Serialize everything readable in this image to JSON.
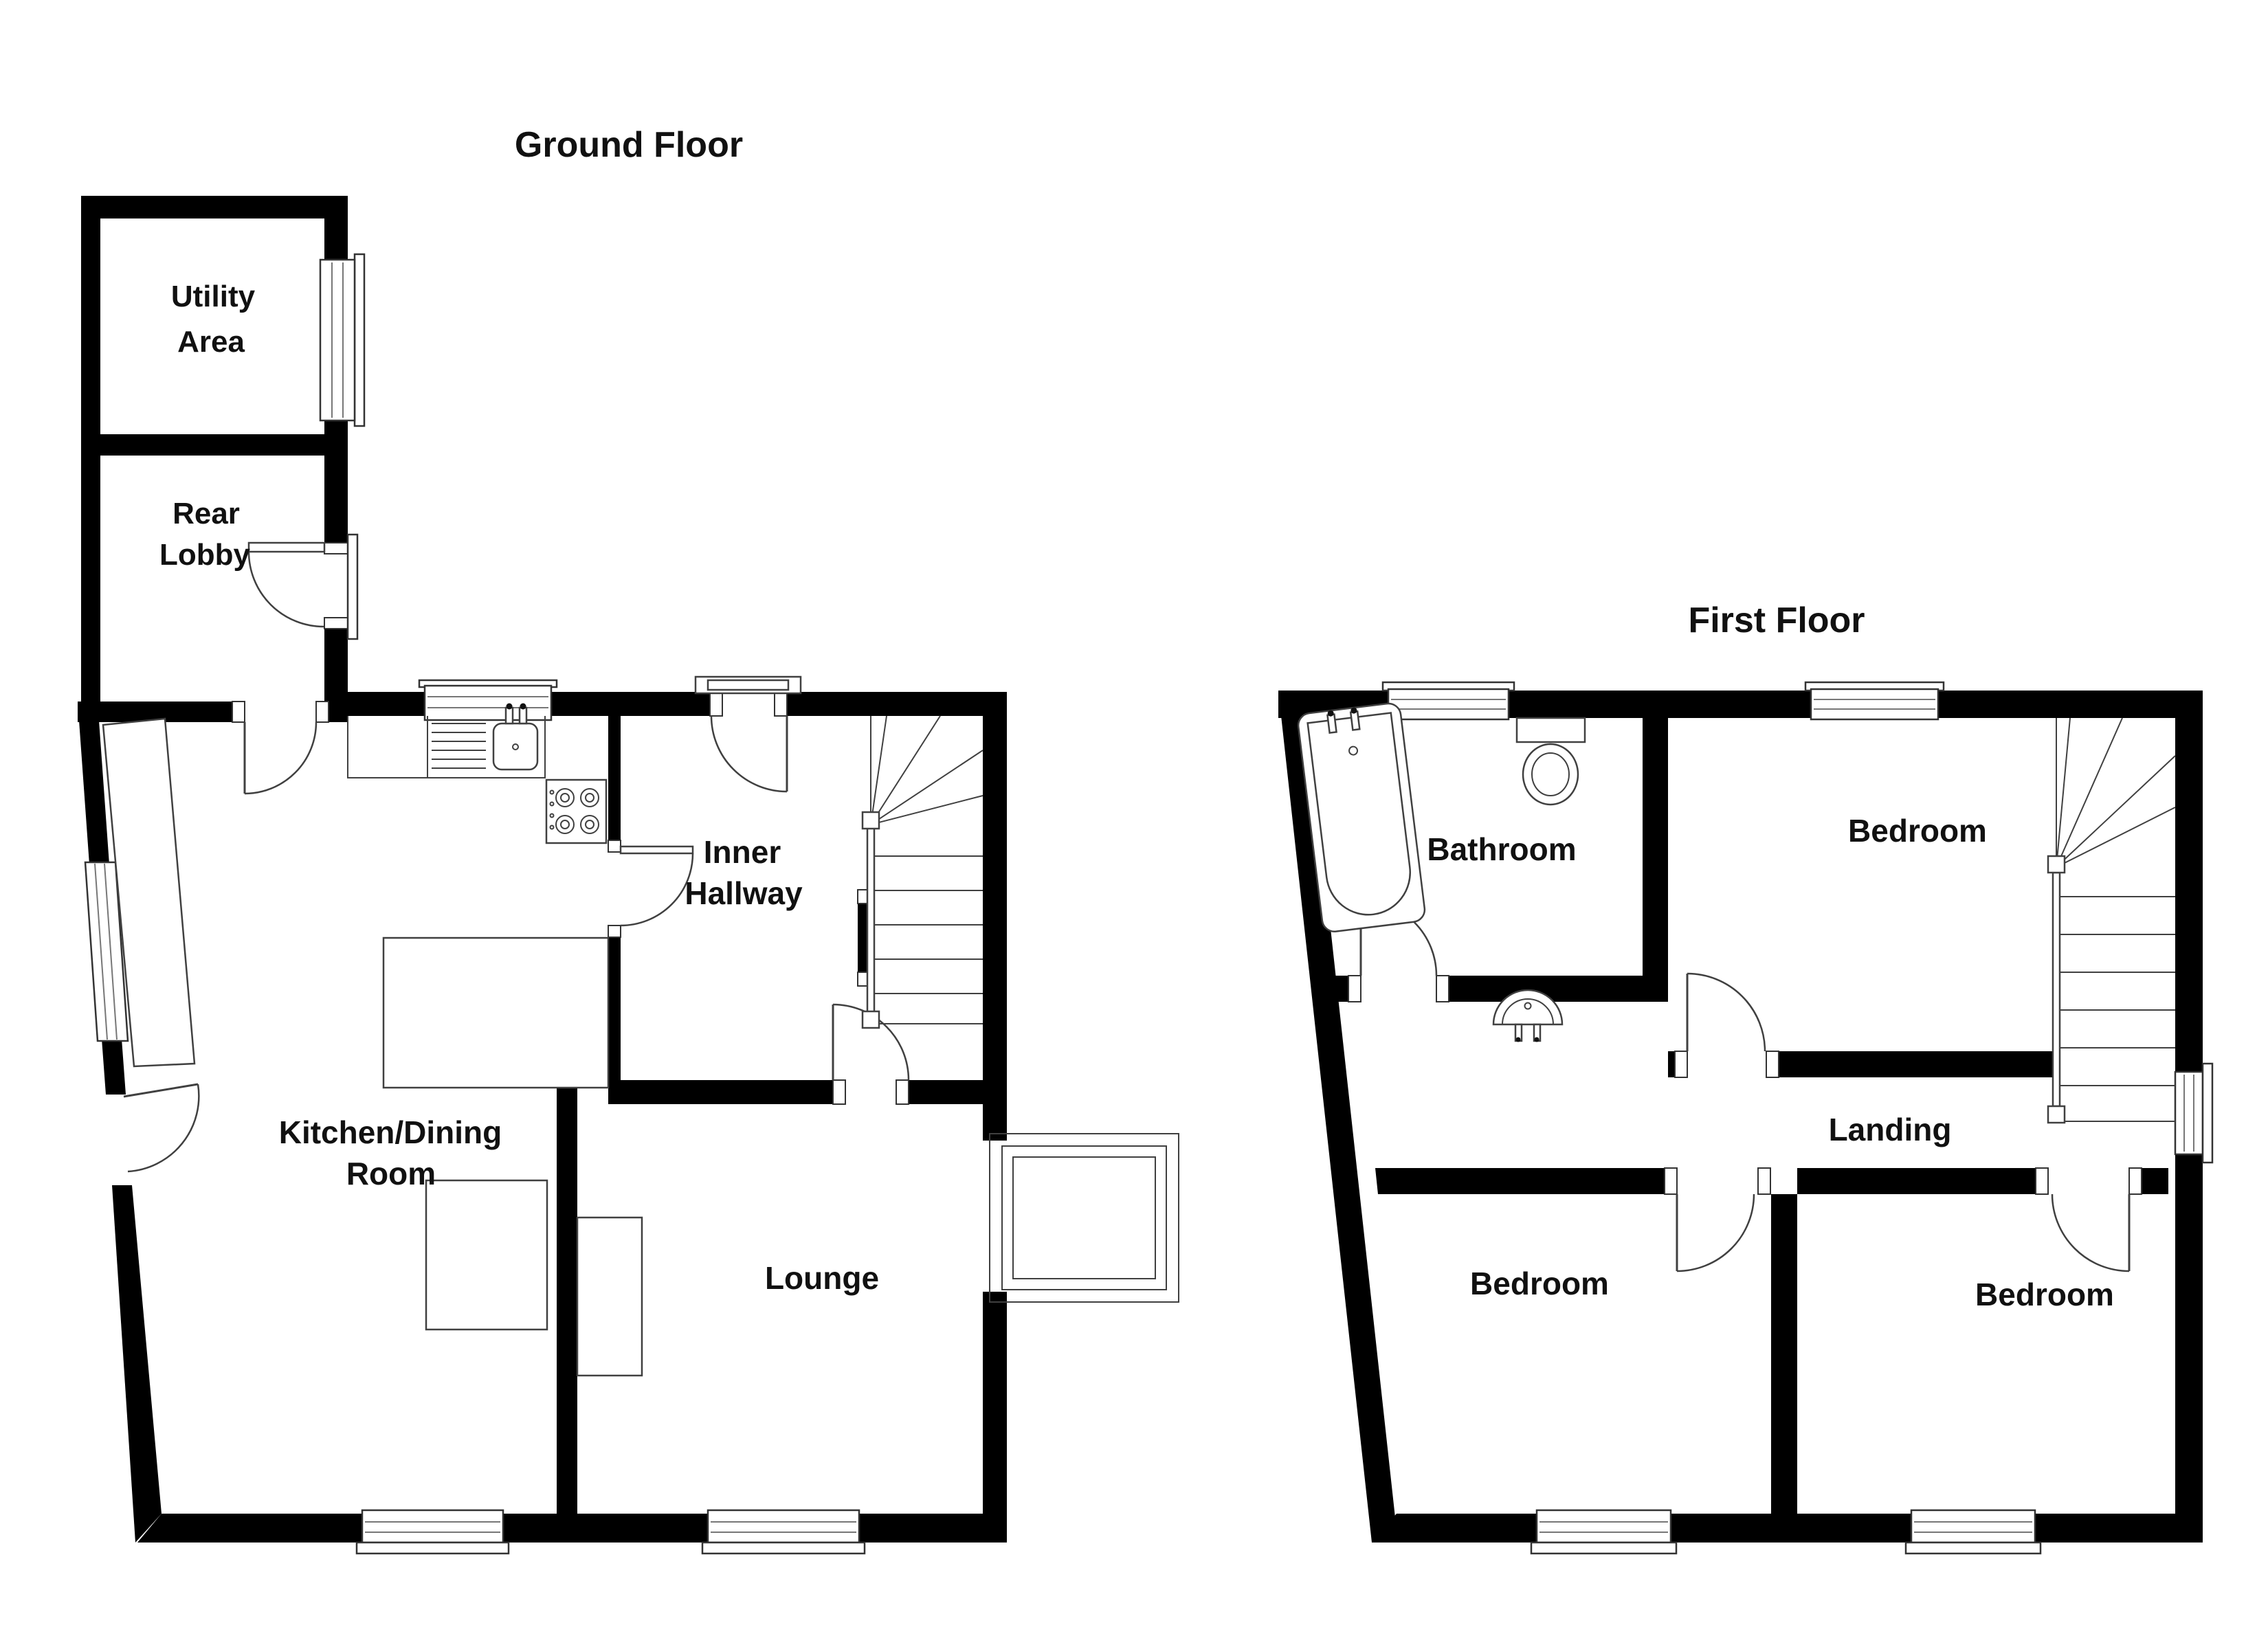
{
  "colors": {
    "wall": "#000000",
    "background": "#ffffff",
    "fixture_line": "#404040",
    "label_text": "#111111"
  },
  "ground_floor": {
    "title": "Ground Floor",
    "rooms": [
      {
        "id": "utility-area",
        "lines": [
          "Utility",
          "Area"
        ]
      },
      {
        "id": "rear-lobby",
        "lines": [
          "Rear",
          "Lobby"
        ]
      },
      {
        "id": "kitchen-dining-room",
        "lines": [
          "Kitchen/Dining",
          "Room"
        ]
      },
      {
        "id": "inner-hallway",
        "lines": [
          "Inner",
          "Hallway"
        ]
      },
      {
        "id": "lounge",
        "lines": [
          "Lounge"
        ]
      }
    ],
    "fixtures": [
      "utility-window",
      "rear-lobby-door",
      "lobby-kitchen-door",
      "front-entrance-door",
      "sink-window",
      "kitchen-counter",
      "kitchen-sink",
      "hob",
      "kitchen-side-unit",
      "dining-table",
      "kitchen-furniture-rect",
      "staircase",
      "hallway-lounge-door",
      "chimney-breast",
      "bay-window",
      "kitchen-window",
      "lounge-window"
    ]
  },
  "first_floor": {
    "title": "First Floor",
    "rooms": [
      {
        "id": "bathroom",
        "lines": [
          "Bathroom"
        ]
      },
      {
        "id": "bedroom-rear",
        "lines": [
          "Bedroom"
        ]
      },
      {
        "id": "landing",
        "lines": [
          "Landing"
        ]
      },
      {
        "id": "bedroom-front-left",
        "lines": [
          "Bedroom"
        ]
      },
      {
        "id": "bedroom-front-right",
        "lines": [
          "Bedroom"
        ]
      }
    ],
    "fixtures": [
      "bathtub",
      "toilet",
      "wash-basin",
      "bathroom-window",
      "bedroom-rear-window",
      "landing-window",
      "staircase",
      "bathroom-door",
      "bedroom-doors",
      "bedroom-front-windows"
    ]
  }
}
